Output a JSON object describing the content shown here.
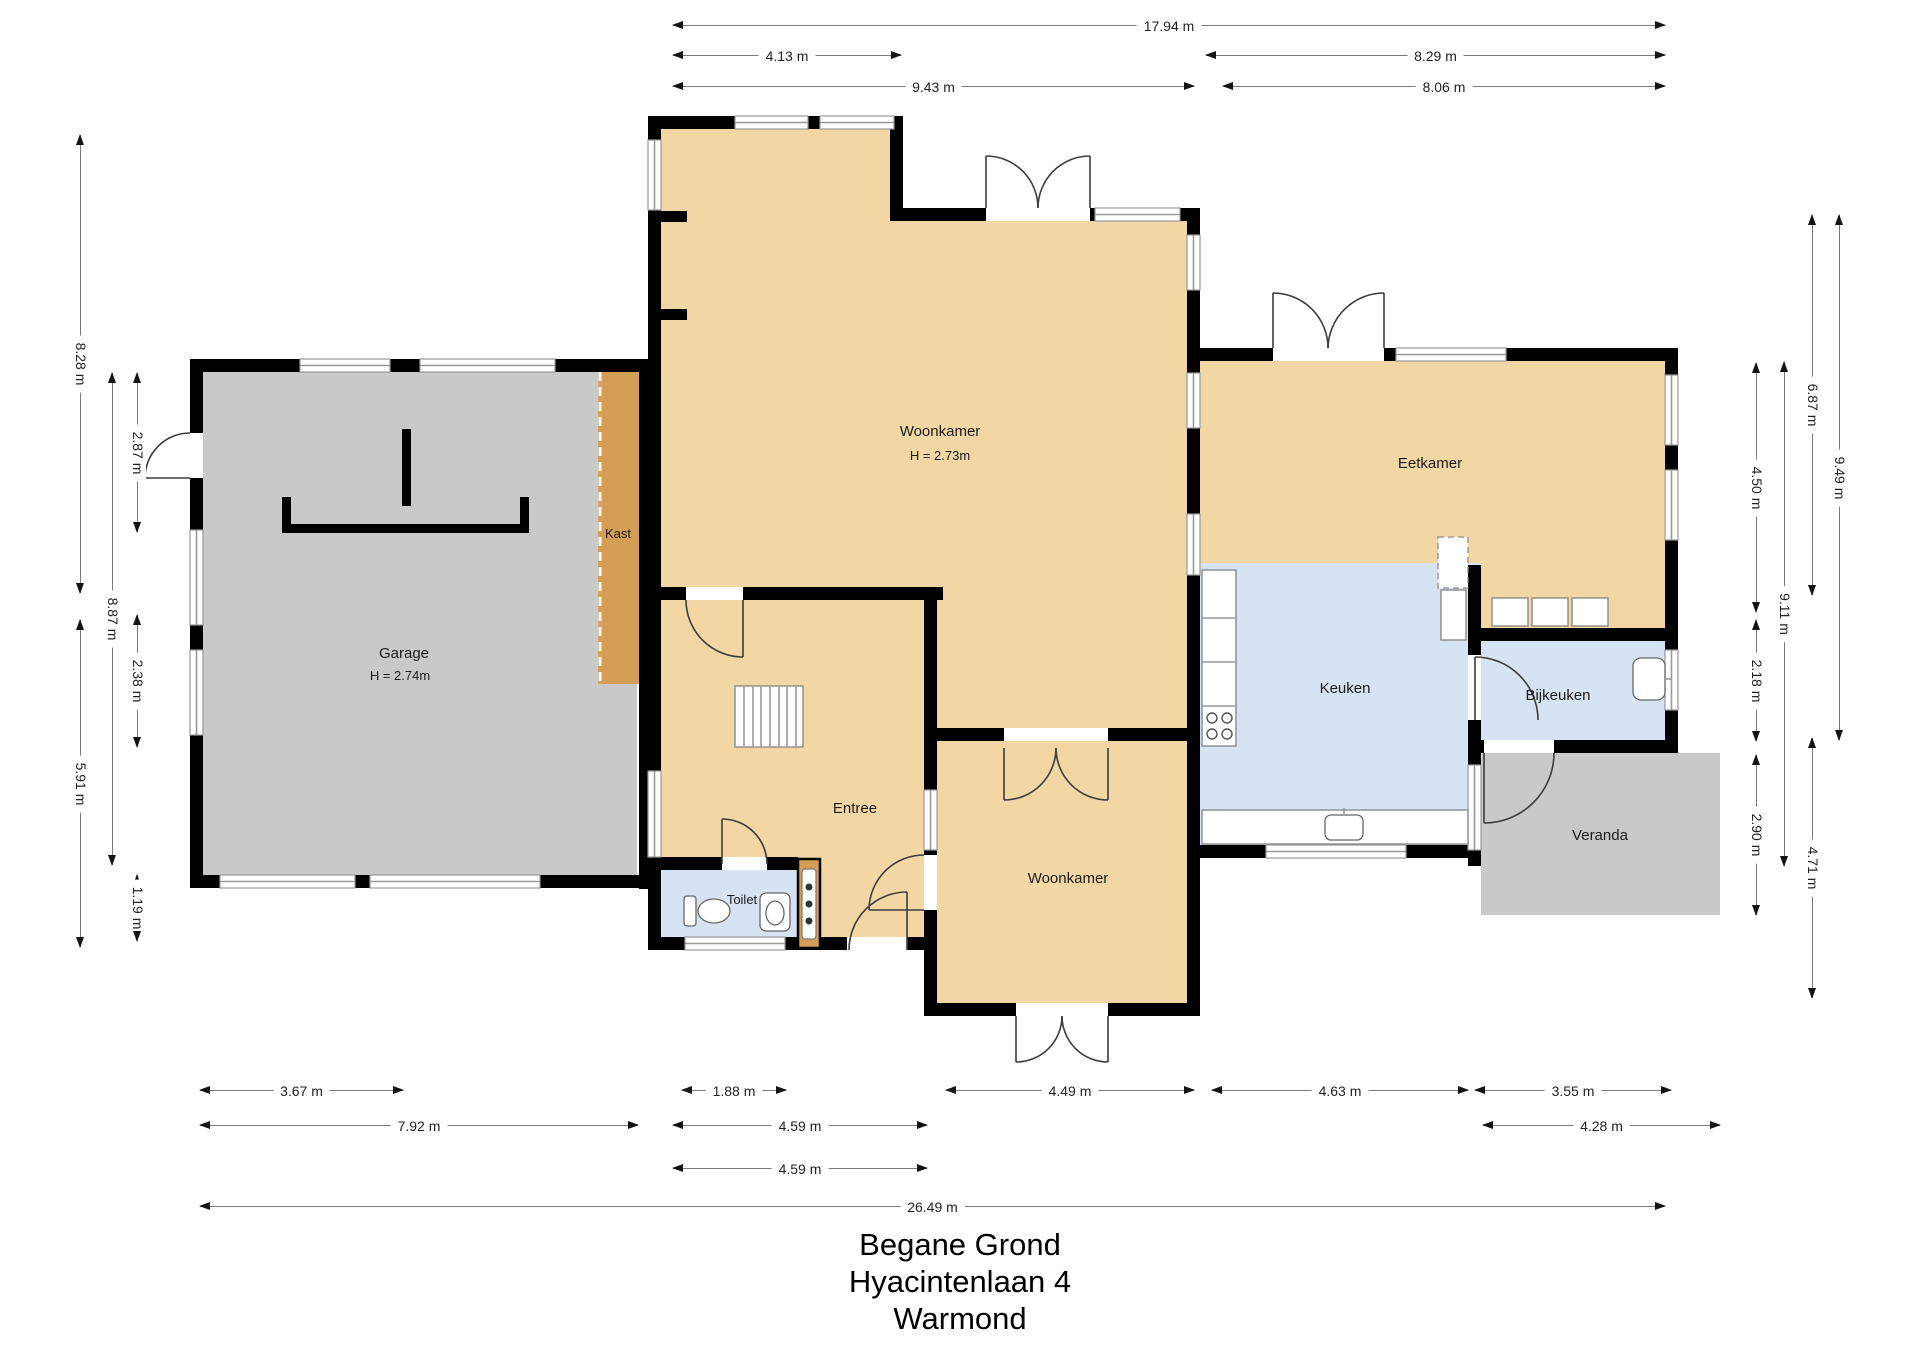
{
  "title": {
    "lines": [
      "Begane Grond",
      "Hyacintenlaan 4",
      "Warmond"
    ]
  },
  "rooms": {
    "woonkamer1": {
      "name": "Woonkamer",
      "height": "H = 2.73m"
    },
    "garage": {
      "name": "Garage",
      "height": "H = 2.74m"
    },
    "kast": {
      "name": "Kast"
    },
    "entree": {
      "name": "Entree"
    },
    "toilet": {
      "name": "Toilet"
    },
    "woonkamer2": {
      "name": "Woonkamer"
    },
    "keuken": {
      "name": "Keuken"
    },
    "bijkeuken": {
      "name": "Bijkeuken"
    },
    "eetkamer": {
      "name": "Eetkamer"
    },
    "veranda": {
      "name": "Veranda"
    }
  },
  "dimensions": {
    "top": [
      {
        "label": "17.94 m"
      },
      {
        "label": "4.13 m"
      },
      {
        "label": "8.29 m"
      },
      {
        "label": "9.43 m"
      },
      {
        "label": "8.06 m"
      }
    ],
    "left": [
      {
        "label": "8.28 m"
      },
      {
        "label": "5.91 m"
      },
      {
        "label": "8.87 m"
      },
      {
        "label": "2.87 m"
      },
      {
        "label": "2.38 m"
      },
      {
        "label": "1.19 m"
      }
    ],
    "right": [
      {
        "label": "4.50 m"
      },
      {
        "label": "2.18 m"
      },
      {
        "label": "2.90 m"
      },
      {
        "label": "9.11 m"
      },
      {
        "label": "6.87 m"
      },
      {
        "label": "4.71 m"
      },
      {
        "label": "9.49 m"
      }
    ],
    "bottom": [
      {
        "label": "3.67 m"
      },
      {
        "label": "1.88 m"
      },
      {
        "label": "4.49 m"
      },
      {
        "label": "4.63 m"
      },
      {
        "label": "3.55 m"
      },
      {
        "label": "7.92 m"
      },
      {
        "label": "4.59 m"
      },
      {
        "label": "4.28 m"
      },
      {
        "label": "4.59 m"
      },
      {
        "label": "26.49 m"
      }
    ]
  },
  "colors": {
    "room_tan": "#f2d7a5",
    "room_blue": "#d5e3f2",
    "room_gray": "#c9c9c9",
    "cabinet_orange": "#d59e55",
    "wall": "#000000",
    "dim_line": "#7a7a7a",
    "dim_text": "#222222"
  }
}
